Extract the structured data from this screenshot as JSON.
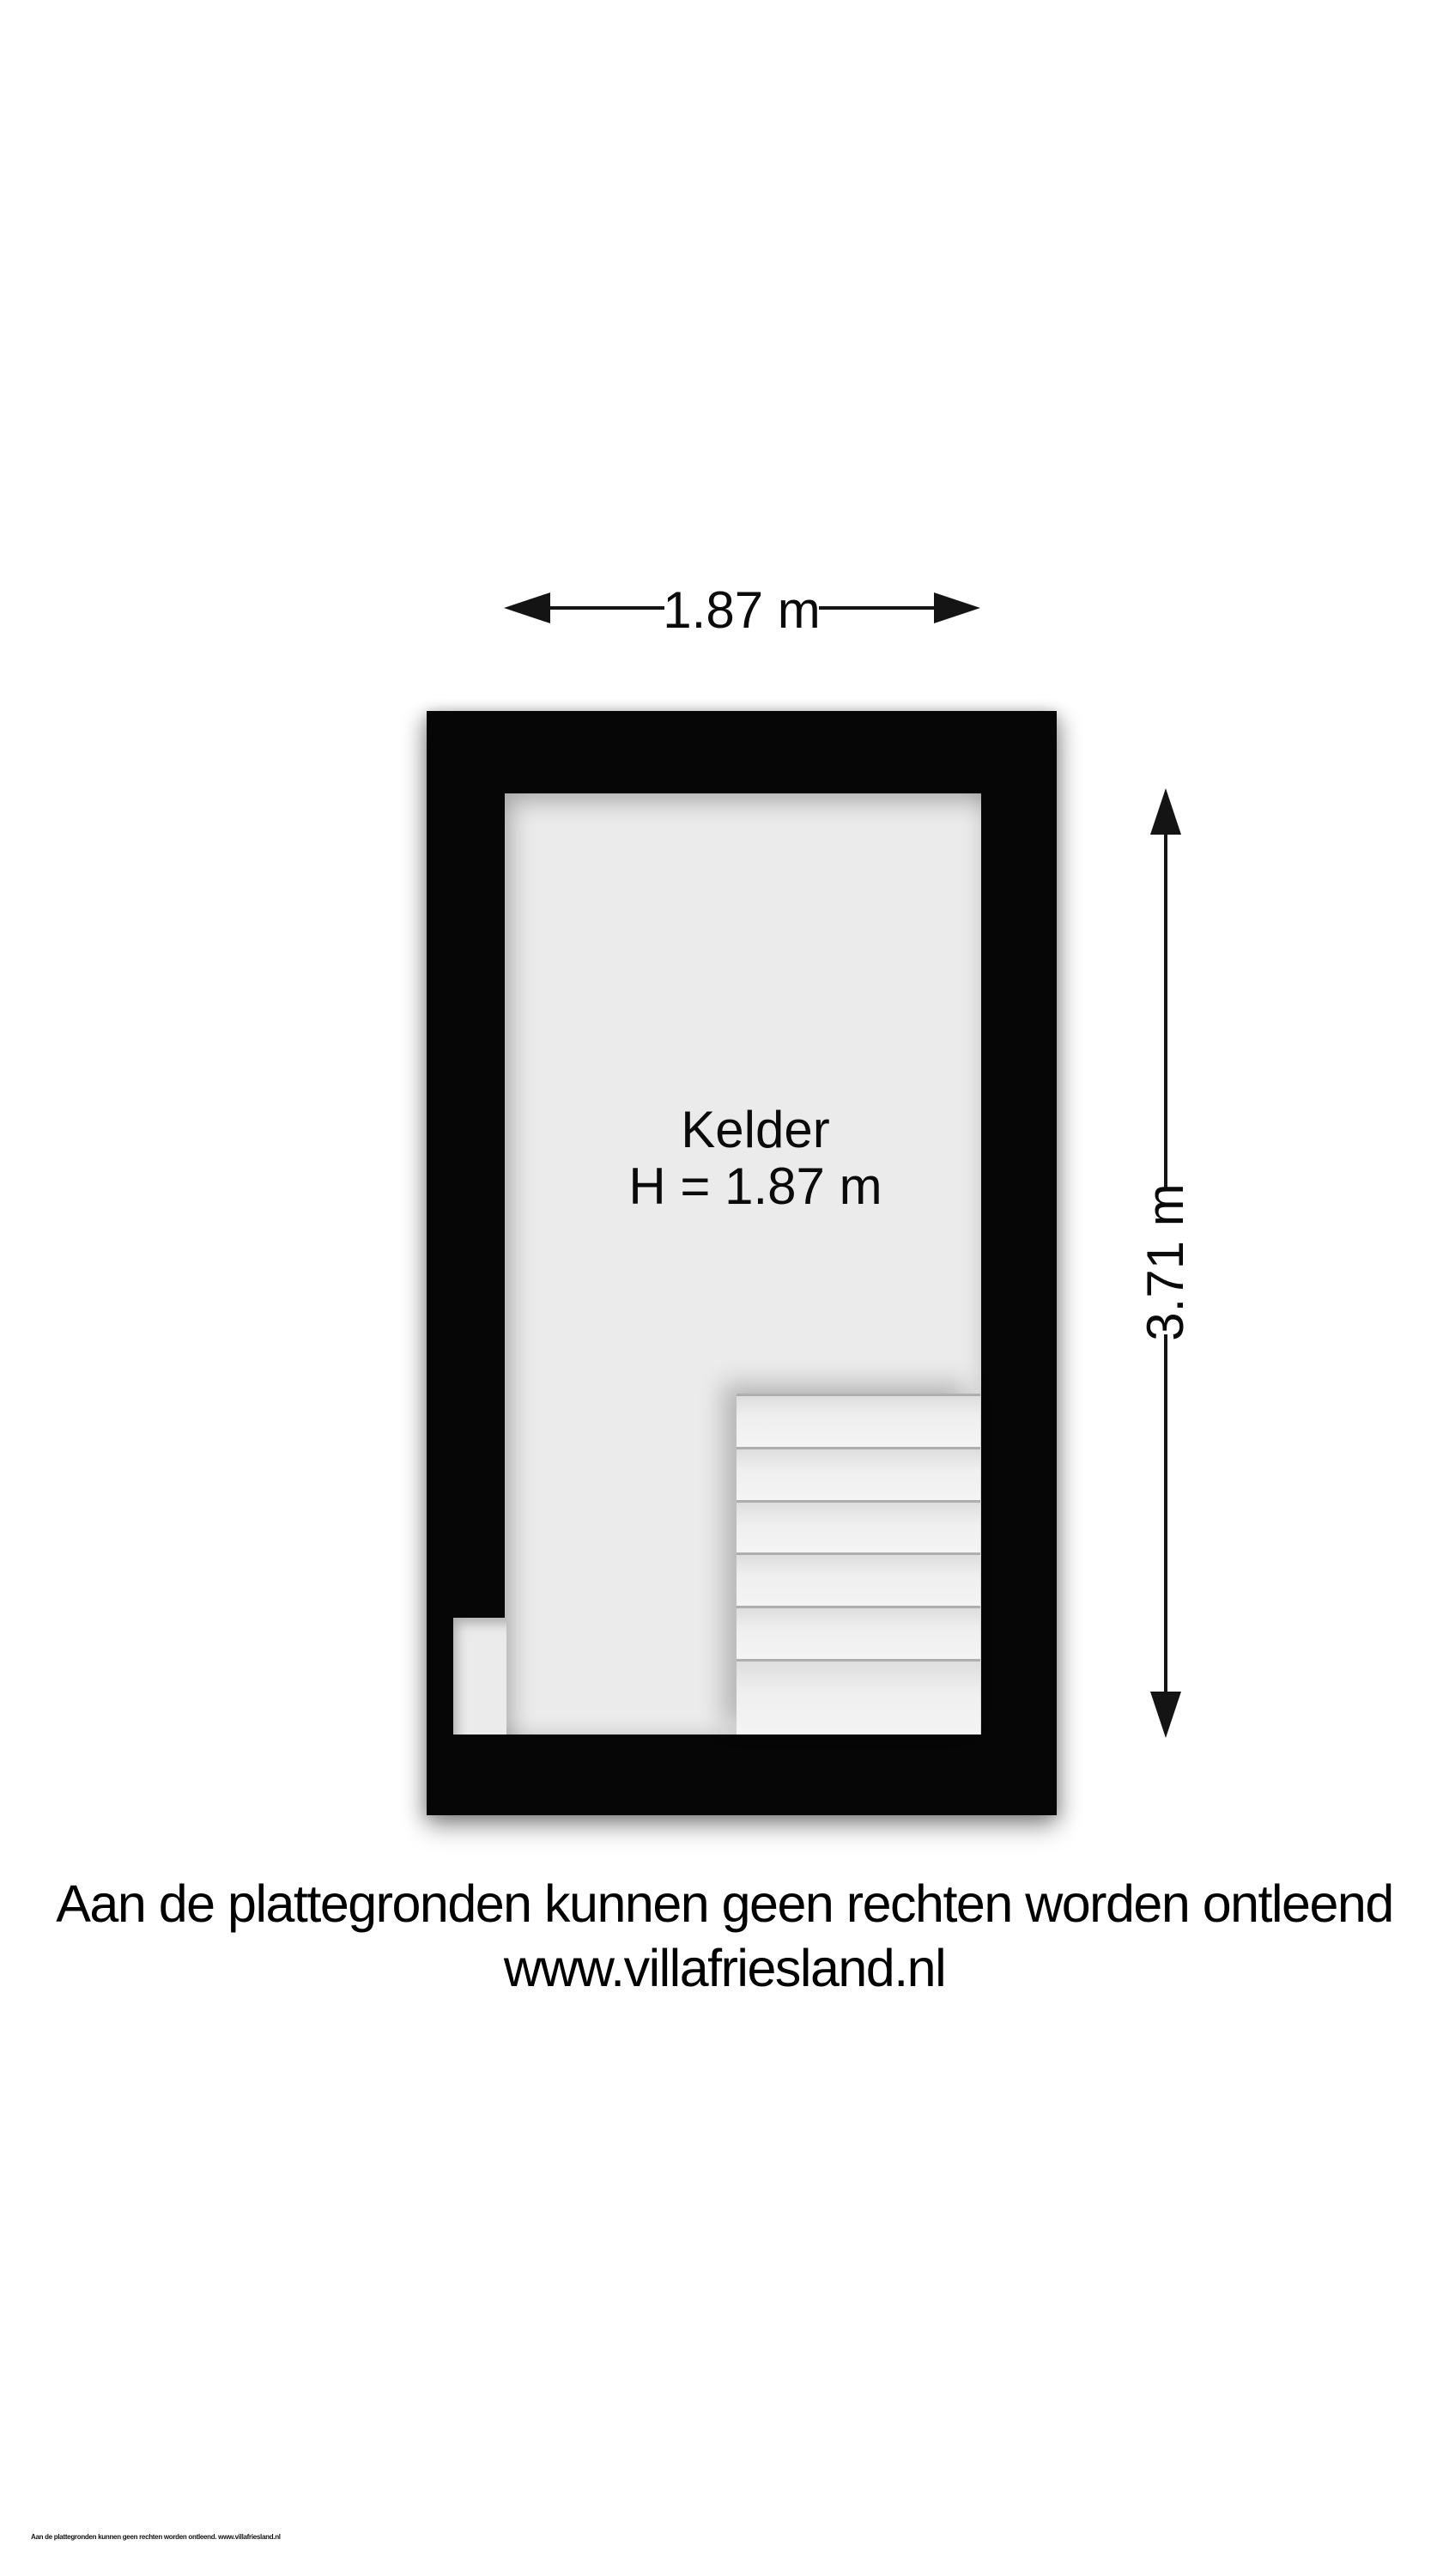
{
  "floorplan": {
    "room": {
      "name": "Kelder",
      "height_label": "H = 1.87 m"
    },
    "dimensions": {
      "width_label": "1.87 m",
      "height_label": "3.71 m"
    },
    "stairs": {
      "step_count": 6
    },
    "colors": {
      "wall": "#060606",
      "floor": "#ebebeb",
      "step": "#f1f1f1",
      "dimension_line": "#141414"
    }
  },
  "footer": {
    "disclaimer": "Aan de plattegronden kunnen geen rechten worden ontleend",
    "website": "www.villafriesland.nl"
  },
  "fineprint": "Aan de plattegronden kunnen geen rechten worden ontleend. www.villafriesland.nl"
}
